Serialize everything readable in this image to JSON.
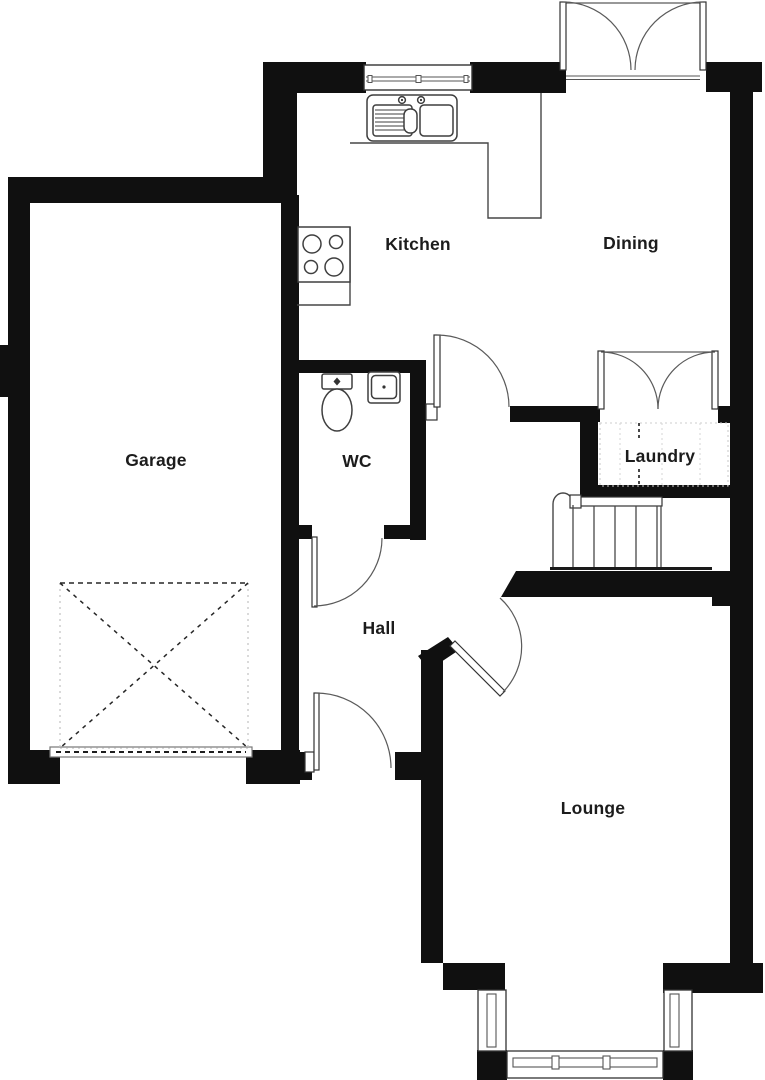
{
  "plan": {
    "rooms": {
      "garage": {
        "label": "Garage"
      },
      "kitchen": {
        "label": "Kitchen"
      },
      "dining": {
        "label": "Dining"
      },
      "wc": {
        "label": "WC"
      },
      "laundry": {
        "label": "Laundry"
      },
      "hall": {
        "label": "Hall"
      },
      "lounge": {
        "label": "Lounge"
      }
    },
    "colors": {
      "wall": "#101010",
      "line": "#474747",
      "background": "#ffffff",
      "label": "#1c1c1c"
    },
    "fixtures": [
      "kitchen-sink",
      "kitchen-hob",
      "kitchen-counter",
      "toilet",
      "wash-basin",
      "staircase",
      "garage-door",
      "garage-door-swing-marking",
      "laundry-worktop-marking",
      "kitchen-window",
      "dining-french-doors",
      "laundry-french-doors",
      "kitchen-hall-door",
      "wc-door",
      "front-door",
      "lounge-hall-door",
      "bay-window"
    ]
  }
}
